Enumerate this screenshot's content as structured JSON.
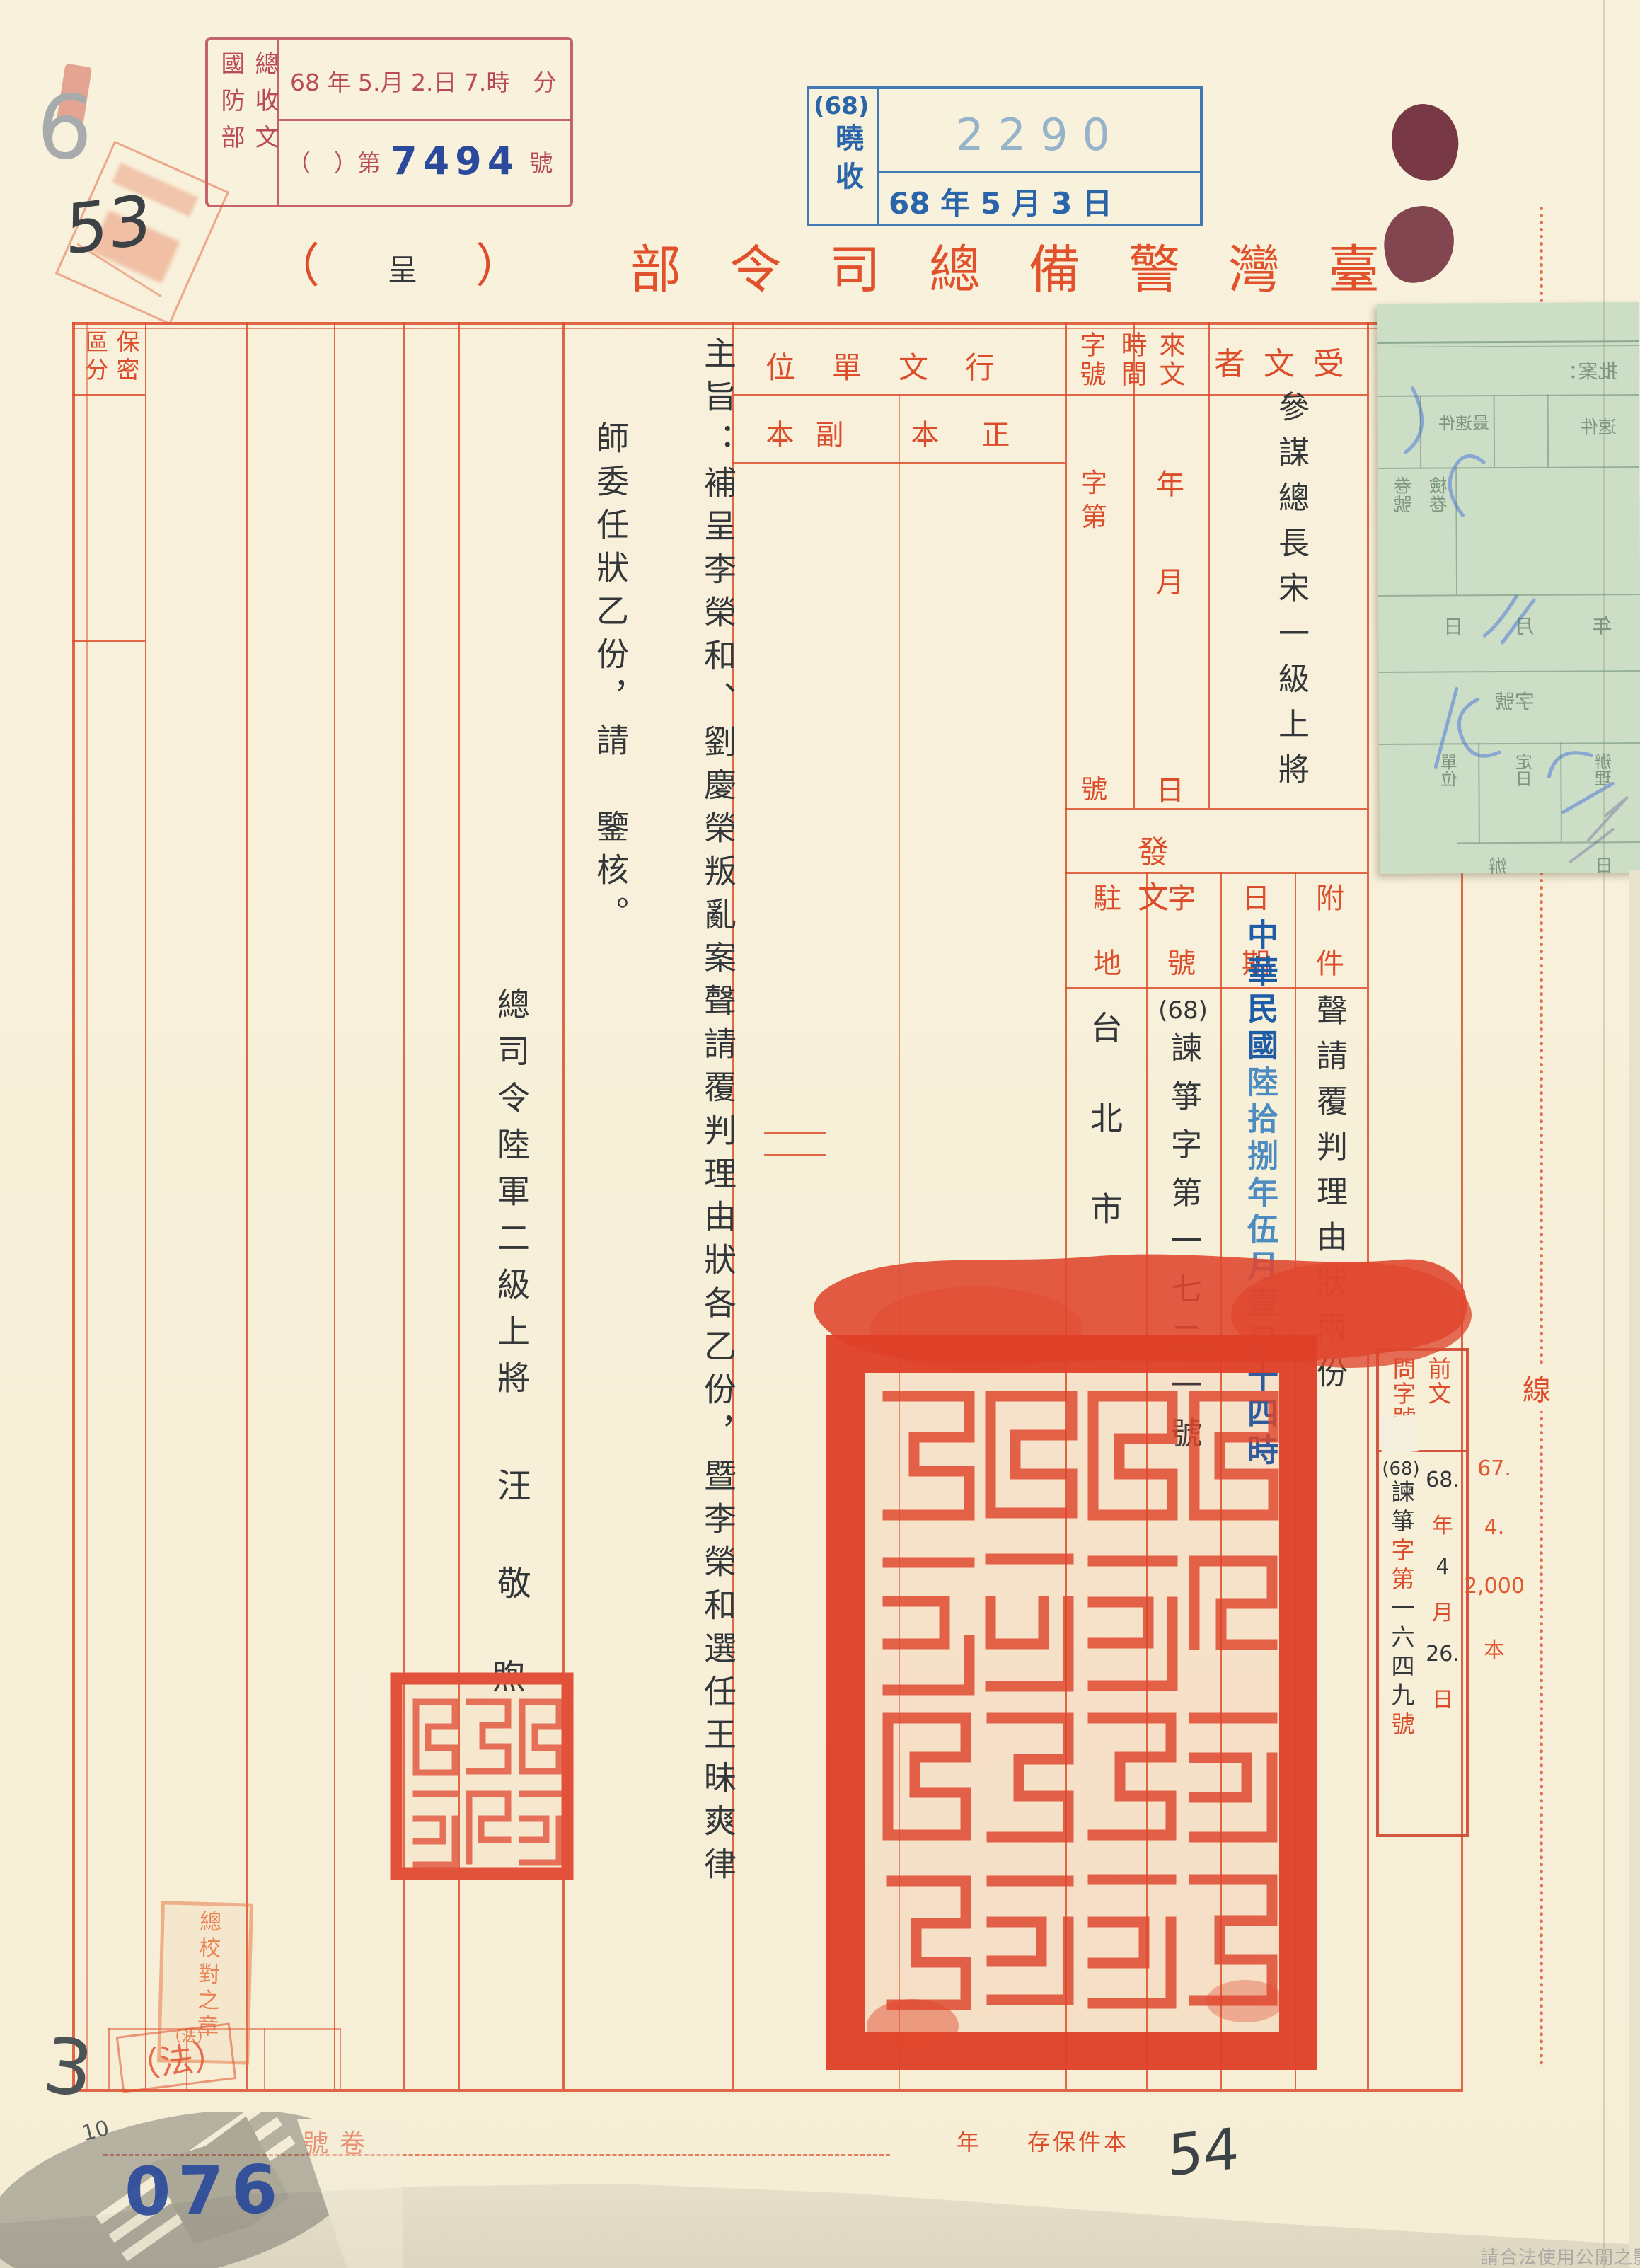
{
  "colors": {
    "form_red": "#dc4e2b",
    "receipt_rose": "#b84b57",
    "stamp_blue": "#2a65aa",
    "serial_blue": "#86a9c8",
    "seal_red": "#df4128",
    "ink": "#34373a",
    "page_no_blue": "#2b4a9b",
    "green_paper": "#ccdfc6"
  },
  "header": {
    "title": "臺灣警備總司令部",
    "paren_open": "（",
    "submit": "呈",
    "paren_close": "）"
  },
  "receipt_stamp": {
    "org_cols": "總收文\n國防部",
    "date_line": "68 年 5.月 2.日 7.時　分",
    "no_open": "（　）第",
    "number": "7494",
    "no_close": "號"
  },
  "intake_stamp": {
    "prefix": "(68)",
    "label": "曉收",
    "serial": "2290",
    "date": "68 年 5 月 3 日"
  },
  "handwriting": {
    "pencil_top": "6",
    "pen_top": "53",
    "pencil_bottom": "3",
    "pencil_aux": "10",
    "folio": "54"
  },
  "page_number": "076",
  "form": {
    "recipient_label": "受文者",
    "recipient": "參謀總長宋一級上將",
    "incoming_label": "來文\n時間",
    "incoming_no_label": "字號",
    "unit_year": "年",
    "unit_month": "月",
    "unit_day": "日",
    "unit_zi": "字",
    "unit_di": "第",
    "unit_hao": "號",
    "dispatch_label": "行文單位",
    "copy_primary": "正本",
    "copy_secondary": "副本",
    "classification": "保密\n區分",
    "sending_label": "發文",
    "attachment_label": "附件",
    "attachment": "聲請覆判理由狀兩份",
    "send_date_label": "日期",
    "send_date_1": "中華民國",
    "send_date_2": "陸拾捌年伍月",
    "send_date_3": "壹日十四時",
    "send_no_label": "字號",
    "send_no_prefix": "(68)",
    "send_no_body": "諫箏字第一七二一號",
    "station_label": "駐地",
    "station": "台北市",
    "subject_label": "主旨：",
    "subject_col1": "補呈李榮和、劉慶榮叛亂案聲請覆判理由狀各乙份，暨李榮和選任王昧爽律",
    "subject_col2": "師委任狀乙份，請　鑒核。",
    "signer_title": "總司令陸軍二級上將",
    "signer_1": "汪",
    "signer_2": "敬",
    "signer_3": "煦"
  },
  "prior_ref": {
    "header": "前文\n問字號",
    "no_prefix": "(68)",
    "no_body": "諫箏",
    "zidi": "字第",
    "digits": "一六四九",
    "hao": "號",
    "date_year": "68.",
    "u_year": "年",
    "date_month": "4",
    "u_month": "月",
    "date_day": "26.",
    "u_day": "日"
  },
  "margin": {
    "print_1": "67.",
    "print_2": "4.",
    "print_3": "2,000",
    "print_4": "本",
    "binding": "線"
  },
  "bottom_row": {
    "volume": "卷號",
    "keep": "本件保存",
    "year_unit": "年"
  },
  "stamps": {
    "proof_text": "總校對之章",
    "proof_suffix": "（法）",
    "law": "（法）"
  },
  "green_slip": {
    "caption": "批案：",
    "l1": "速件",
    "l2": "最速件",
    "l3": "檢卷",
    "l4": "卷號",
    "l5": "年",
    "l6": "月",
    "l7": "日",
    "l8": "字號",
    "l9": "辦理",
    "l10": "定日",
    "l11": "單位",
    "l12": "日",
    "l13": "辦"
  },
  "notice": "請合法使用公開之影像"
}
